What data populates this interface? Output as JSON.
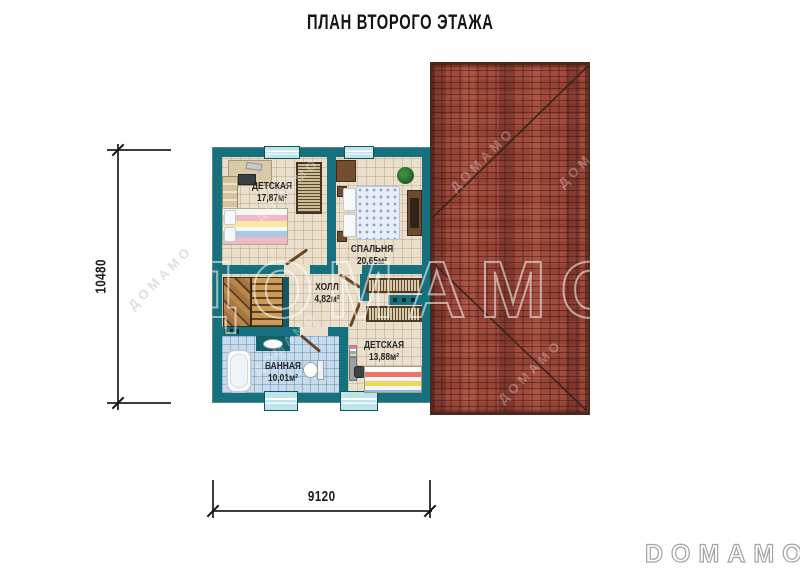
{
  "title": "ПЛАН ВТОРОГО ЭТАЖА",
  "rooms": [
    {
      "name": "ДЕТСКАЯ",
      "area": "17,87м²"
    },
    {
      "name": "СПАЛЬНЯ",
      "area": "20,65м²"
    },
    {
      "name": "ХОЛЛ",
      "area": "4,82м²"
    },
    {
      "name": "ВАННАЯ",
      "area": "10,01м²"
    },
    {
      "name": "ДЕТСКАЯ",
      "area": "13,88м²"
    }
  ],
  "dimensions": {
    "height_mm": "10480",
    "width_mm": "9120"
  },
  "branding": {
    "watermark": "ДОМАМО",
    "logo": "DOMAMO"
  },
  "colors": {
    "wall_teal": "#15717e",
    "floor_beige": "#eadfca",
    "bath_tile": "#c6dcec",
    "roof_brick": "#a04b3d",
    "window_blue": "#bfe3ea",
    "stair_wood": "#b98d52"
  }
}
